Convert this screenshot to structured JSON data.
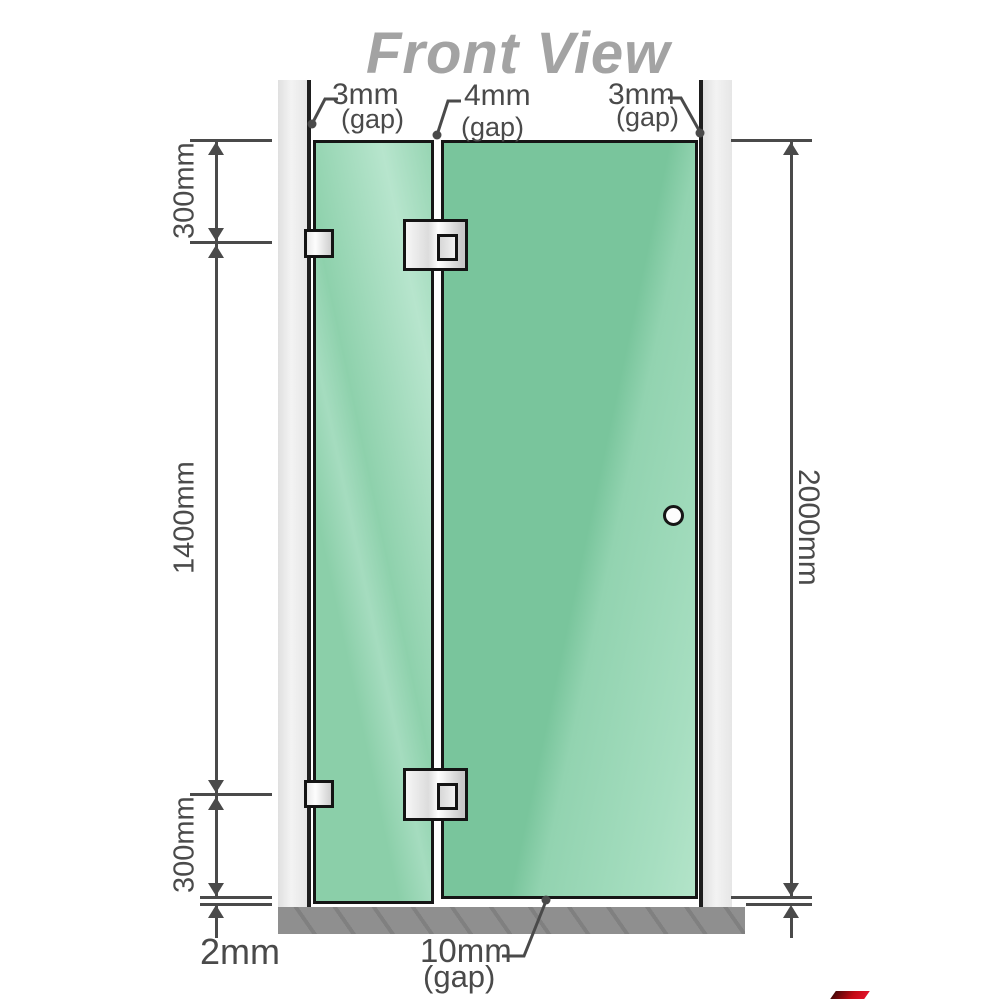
{
  "title": "Front View",
  "colors": {
    "glass_green": "#7fc8a1",
    "glass_highlight": "#b3e4c9",
    "wall_gray": "#ebebeb",
    "floor_gray": "#8f8f8f",
    "line_dark": "#4a4a4a",
    "title_gray": "#a3a3a3",
    "hardware_silver": "#dcdcdc",
    "panel_border": "#161616"
  },
  "labels": {
    "gap_left": {
      "value": "3mm",
      "qualifier": "(gap)"
    },
    "gap_middle": {
      "value": "4mm",
      "qualifier": "(gap)"
    },
    "gap_right": {
      "value": "3mm",
      "qualifier": "(gap)"
    },
    "segment_top": "300mm",
    "segment_middle": "1400mm",
    "segment_bottom": "300mm",
    "floor_gap": "2mm",
    "total_height": "2000mm",
    "door_bottom_gap": {
      "value": "10mm",
      "qualifier": "(gap)"
    }
  }
}
